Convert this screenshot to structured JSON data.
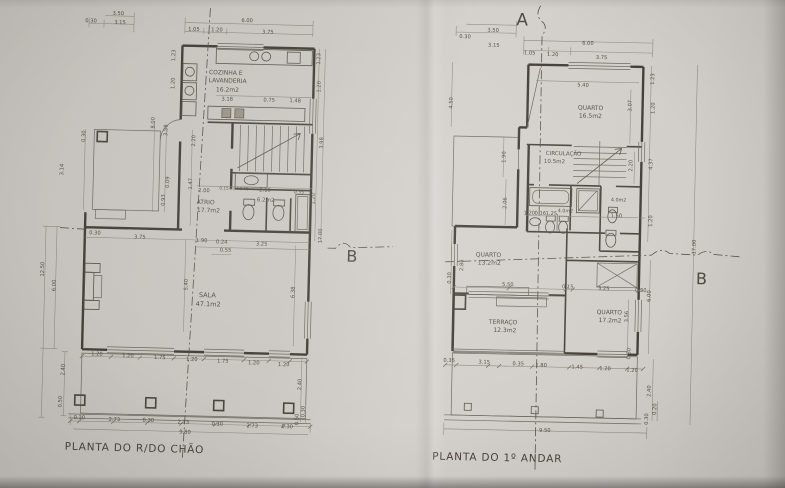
{
  "photo": {
    "description_colors": {
      "paper": "#cfccc7",
      "ink": "#46403a",
      "ink_light": "#8d877d"
    }
  },
  "left_plan": {
    "title": "PLANTA DO R/DO CHÃO",
    "section_b": "B",
    "rooms": [
      {
        "name": "COZINHA E LAVANDERIA",
        "area": "16.2m2"
      },
      {
        "name": "ATRIO",
        "area": "17.7m2"
      },
      {
        "name": "WC",
        "area": "6.2m2"
      },
      {
        "name": "SALA",
        "area": "47.1m2"
      }
    ],
    "labels": [
      {
        "t": "3.50",
        "x": 113,
        "y": 17
      },
      {
        "t": "0.30",
        "x": 86,
        "y": 25
      },
      {
        "t": "3.15",
        "x": 115,
        "y": 26
      },
      {
        "t": "6.00",
        "x": 242,
        "y": 21
      },
      {
        "t": "1.05",
        "x": 189,
        "y": 31
      },
      {
        "t": "1.20",
        "x": 212,
        "y": 31
      },
      {
        "t": "3.75",
        "x": 263,
        "y": 32
      },
      {
        "t": "COZINHA E",
        "x": 222,
        "y": 74,
        "s": 6,
        "n": "room-label"
      },
      {
        "t": "LAVANDERIA",
        "x": 224,
        "y": 82,
        "s": 6,
        "n": "room-label"
      },
      {
        "t": "16.2m2",
        "x": 224,
        "y": 91,
        "s": 6,
        "n": "room-area"
      },
      {
        "t": "3.18",
        "x": 224,
        "y": 100
      },
      {
        "t": "0.75",
        "x": 266,
        "y": 100
      },
      {
        "t": "1.48",
        "x": 292,
        "y": 100
      },
      {
        "t": "1.23",
        "x": 171,
        "y": 56,
        "r": -90
      },
      {
        "t": "1.20",
        "x": 171,
        "y": 84,
        "r": -90
      },
      {
        "t": "1.23",
        "x": 316,
        "y": 56,
        "r": -90
      },
      {
        "t": "1.20",
        "x": 317,
        "y": 84,
        "r": -90
      },
      {
        "t": "3.98",
        "x": 321,
        "y": 140,
        "r": -90
      },
      {
        "t": "1.20",
        "x": 314,
        "y": 196,
        "r": -90
      },
      {
        "t": "17.00",
        "x": 322,
        "y": 233,
        "r": -90
      },
      {
        "t": "0.30",
        "x": 83,
        "y": 139,
        "r": -90
      },
      {
        "t": "3.14",
        "x": 62,
        "y": 173,
        "r": -90
      },
      {
        "t": "8.00",
        "x": 152,
        "y": 124,
        "r": -90
      },
      {
        "t": "3.58",
        "x": 165,
        "y": 131,
        "r": -90
      },
      {
        "t": "0.09",
        "x": 168,
        "y": 183,
        "r": -90
      },
      {
        "t": "0.93",
        "x": 164,
        "y": 201,
        "r": -90
      },
      {
        "t": "2.20",
        "x": 193,
        "y": 141,
        "r": -90
      },
      {
        "t": "1.47",
        "x": 191,
        "y": 184,
        "r": -90
      },
      {
        "t": "2.00",
        "x": 203,
        "y": 192
      },
      {
        "t": "0.15",
        "x": 223,
        "y": 189,
        "s": 4.2
      },
      {
        "t": "0.84",
        "x": 233,
        "y": 189,
        "s": 4.2
      },
      {
        "t": "0.15",
        "x": 243,
        "y": 189,
        "s": 4.2
      },
      {
        "t": "2.16",
        "x": 264,
        "y": 190
      },
      {
        "t": "0.35",
        "x": 298,
        "y": 191,
        "s": 4.5
      },
      {
        "t": "ATRIO",
        "x": 205,
        "y": 204,
        "s": 6,
        "n": "room-label"
      },
      {
        "t": "17.7m2",
        "x": 208,
        "y": 212,
        "s": 6,
        "n": "room-area"
      },
      {
        "t": "6.2m2",
        "x": 265,
        "y": 200,
        "s": 5.5,
        "n": "room-area"
      },
      {
        "t": "0.30",
        "x": 95,
        "y": 237
      },
      {
        "t": "3.75",
        "x": 140,
        "y": 240
      },
      {
        "t": "1.90",
        "x": 202,
        "y": 242
      },
      {
        "t": "0.24",
        "x": 222,
        "y": 243
      },
      {
        "t": "3.25",
        "x": 262,
        "y": 244
      },
      {
        "t": "0.55",
        "x": 226,
        "y": 251
      },
      {
        "t": "SALA",
        "x": 209,
        "y": 297,
        "s": 6.5,
        "n": "room-label"
      },
      {
        "t": "47.1m2",
        "x": 210,
        "y": 306,
        "s": 6.5,
        "n": "room-area"
      },
      {
        "t": "5.40",
        "x": 189,
        "y": 285,
        "r": -90
      },
      {
        "t": "6.38",
        "x": 296,
        "y": 290,
        "r": -90
      },
      {
        "t": "12.50",
        "x": 45,
        "y": 273,
        "r": -90
      },
      {
        "t": "6.00",
        "x": 57,
        "y": 289,
        "r": -90
      },
      {
        "t": "2.40",
        "x": 68,
        "y": 373,
        "r": -90
      },
      {
        "t": "0.50",
        "x": 66,
        "y": 405,
        "r": -90
      },
      {
        "t": "1.20",
        "x": 100,
        "y": 358
      },
      {
        "t": "1.20",
        "x": 131,
        "y": 359
      },
      {
        "t": "1.75",
        "x": 163,
        "y": 360
      },
      {
        "t": "1.20",
        "x": 195,
        "y": 361
      },
      {
        "t": "1.75",
        "x": 226,
        "y": 362
      },
      {
        "t": "1.20",
        "x": 257,
        "y": 363
      },
      {
        "t": "1.20",
        "x": 287,
        "y": 364
      },
      {
        "t": "0.30",
        "x": 84,
        "y": 422
      },
      {
        "t": "2.73",
        "x": 119,
        "y": 423
      },
      {
        "t": "0.30",
        "x": 153,
        "y": 423
      },
      {
        "t": "2.73",
        "x": 188,
        "y": 424
      },
      {
        "t": "0.30",
        "x": 222,
        "y": 425
      },
      {
        "t": "2.73",
        "x": 257,
        "y": 426
      },
      {
        "t": "0.30",
        "x": 292,
        "y": 426
      },
      {
        "t": "9.80",
        "x": 190,
        "y": 434
      },
      {
        "t": "2.40",
        "x": 305,
        "y": 382,
        "r": -90
      },
      {
        "t": "0.30",
        "x": 309,
        "y": 409,
        "r": -90
      },
      {
        "t": "0.50",
        "x": 303,
        "y": 417,
        "r": -90
      }
    ]
  },
  "right_plan": {
    "title": "PLANTA DO 1º ANDAR",
    "section_a": "A",
    "section_b": "B",
    "rooms": [
      {
        "name": "QUARTO",
        "area": "16.5m2"
      },
      {
        "name": "CIRCULAÇÃO",
        "area": "10.5m2"
      },
      {
        "name": "I.S.",
        "area": "4.0m2"
      },
      {
        "name": "I.S.",
        "area": "4.0m2"
      },
      {
        "name": "QUARTO",
        "area": "13.2m2"
      },
      {
        "name": "TERRAÇO",
        "area": "12.3m2"
      },
      {
        "name": "QUARTO",
        "area": "17.2m2"
      }
    ],
    "labels": [
      {
        "t": "3.50",
        "x": 489,
        "y": 33
      },
      {
        "t": "0.30",
        "x": 461,
        "y": 40
      },
      {
        "t": "3.15",
        "x": 490,
        "y": 48
      },
      {
        "t": "6.00",
        "x": 584,
        "y": 44
      },
      {
        "t": "1.05",
        "x": 526,
        "y": 55
      },
      {
        "t": "1.20",
        "x": 549,
        "y": 56
      },
      {
        "t": "3.75",
        "x": 598,
        "y": 58
      },
      {
        "t": "5.40",
        "x": 580,
        "y": 86
      },
      {
        "t": "QUARTO",
        "x": 588,
        "y": 109,
        "s": 6,
        "n": "room-label"
      },
      {
        "t": "16.5m2",
        "x": 588,
        "y": 117,
        "s": 6,
        "n": "room-area"
      },
      {
        "t": "4.50",
        "x": 450,
        "y": 105,
        "r": -90
      },
      {
        "t": "1.23",
        "x": 651,
        "y": 77,
        "r": -90
      },
      {
        "t": "3.07",
        "x": 629,
        "y": 104,
        "r": -90
      },
      {
        "t": "1.20",
        "x": 652,
        "y": 106,
        "r": -90
      },
      {
        "t": "2.20",
        "x": 631,
        "y": 164,
        "r": -90
      },
      {
        "t": "4.37",
        "x": 651,
        "y": 162,
        "r": -90
      },
      {
        "t": "1.20",
        "x": 652,
        "y": 219,
        "r": -90
      },
      {
        "t": "CIRCULAÇÃO",
        "x": 562,
        "y": 155,
        "s": 5.5,
        "n": "room-label"
      },
      {
        "t": "10.5m2",
        "x": 553,
        "y": 163,
        "s": 5.5,
        "n": "room-area"
      },
      {
        "t": "1.90",
        "x": 504,
        "y": 158,
        "r": -90
      },
      {
        "t": "2.06",
        "x": 506,
        "y": 204,
        "r": -90
      },
      {
        "t": "1.20",
        "x": 529,
        "y": 215
      },
      {
        "t": "0.16",
        "x": 540,
        "y": 215
      },
      {
        "t": "1.25",
        "x": 551,
        "y": 215
      },
      {
        "t": "4.0m2",
        "x": 565,
        "y": 212,
        "s": 4.8,
        "n": "room-area"
      },
      {
        "t": "4.0m2",
        "x": 618,
        "y": 200,
        "s": 4.8,
        "n": "room-area"
      },
      {
        "t": "1.50",
        "x": 616,
        "y": 216
      },
      {
        "t": "QUARTO",
        "x": 489,
        "y": 258,
        "s": 6,
        "n": "room-label"
      },
      {
        "t": "13.2m2",
        "x": 490,
        "y": 266,
        "s": 6,
        "n": "room-area"
      },
      {
        "t": "2.88",
        "x": 464,
        "y": 267,
        "r": -90
      },
      {
        "t": "0.30",
        "x": 452,
        "y": 280,
        "r": -90
      },
      {
        "t": "5.50",
        "x": 509,
        "y": 287
      },
      {
        "t": "0.15",
        "x": 569,
        "y": 288
      },
      {
        "t": "3.25",
        "x": 605,
        "y": 289
      },
      {
        "t": "0.30",
        "x": 642,
        "y": 290
      },
      {
        "t": "TERRAÇO",
        "x": 505,
        "y": 325,
        "s": 6,
        "n": "room-label"
      },
      {
        "t": "12.3m2",
        "x": 507,
        "y": 333,
        "s": 6,
        "n": "room-area"
      },
      {
        "t": "QUARTO",
        "x": 611,
        "y": 313,
        "s": 6,
        "n": "room-label"
      },
      {
        "t": "17.2m2",
        "x": 612,
        "y": 321,
        "s": 6,
        "n": "room-area"
      },
      {
        "t": "3.56",
        "x": 630,
        "y": 315,
        "r": -90
      },
      {
        "t": "6.00",
        "x": 652,
        "y": 294,
        "r": -90
      },
      {
        "t": "0.30",
        "x": 633,
        "y": 352,
        "r": -90
      },
      {
        "t": "0.35",
        "x": 452,
        "y": 364
      },
      {
        "t": "3.15",
        "x": 487,
        "y": 365
      },
      {
        "t": "0.35",
        "x": 521,
        "y": 366
      },
      {
        "t": "1.80",
        "x": 544,
        "y": 367
      },
      {
        "t": "1.45",
        "x": 580,
        "y": 368
      },
      {
        "t": "1.20",
        "x": 608,
        "y": 369
      },
      {
        "t": "1.20",
        "x": 635,
        "y": 370
      },
      {
        "t": "9.50",
        "x": 549,
        "y": 432
      },
      {
        "t": "2.40",
        "x": 654,
        "y": 389,
        "r": -90
      },
      {
        "t": "0.20",
        "x": 660,
        "y": 407,
        "r": -90
      },
      {
        "t": "0.30",
        "x": 652,
        "y": 417,
        "r": -90
      },
      {
        "t": "17.00",
        "x": 696,
        "y": 244,
        "r": -90
      }
    ]
  }
}
